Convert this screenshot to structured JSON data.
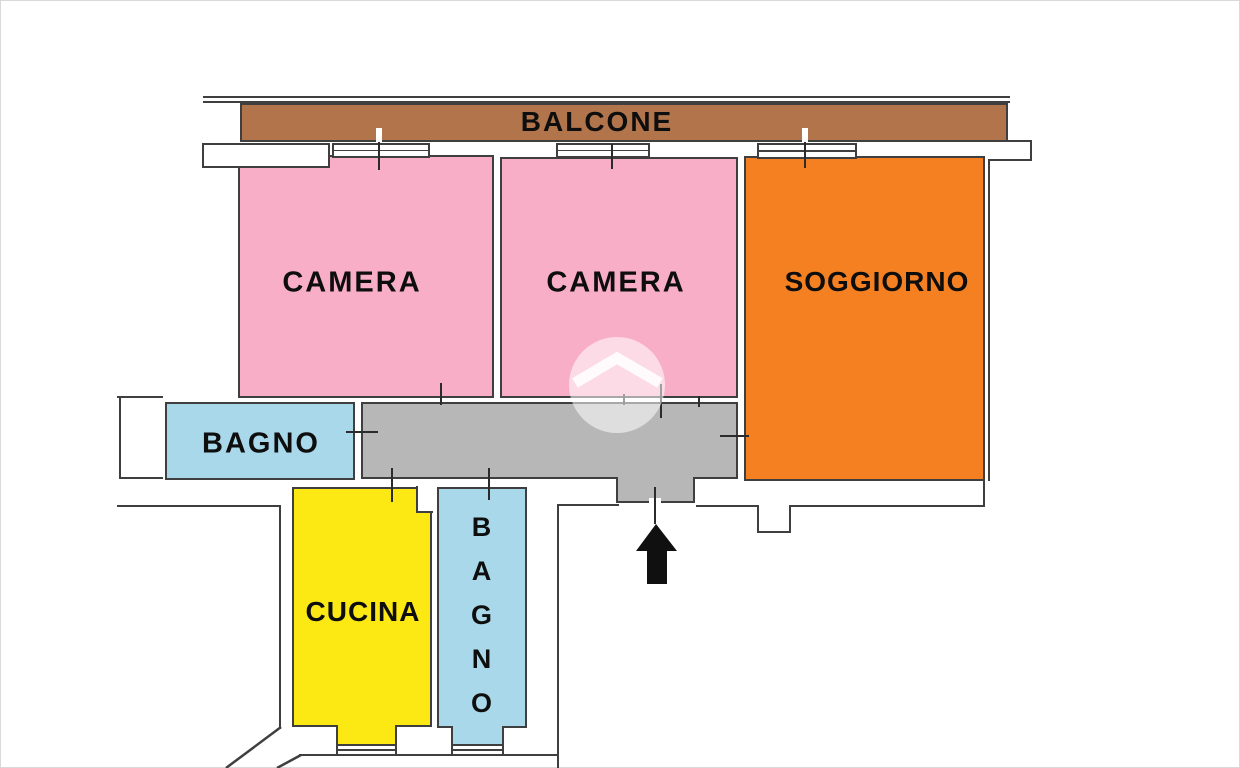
{
  "floor_plan": {
    "rooms": {
      "balcone": {
        "label": "BALCONE",
        "color": "#b1744b"
      },
      "camera_1": {
        "label": "CAMERA",
        "color": "#f9aec8"
      },
      "camera_2": {
        "label": "CAMERA",
        "color": "#f9aec8"
      },
      "soggiorno": {
        "label": "SOGGIORNO",
        "color": "#f58021"
      },
      "bagno_1": {
        "label": "BAGNO",
        "color": "#a8d8ea"
      },
      "cucina": {
        "label": "CUCINA",
        "color": "#fce813"
      },
      "bagno_2": {
        "label": "BAGNO",
        "color": "#a8d8ea"
      },
      "corridoio": {
        "label": "",
        "color": "#b7b7b7"
      }
    },
    "icons": {
      "entrance_arrow": "arrow-up-black",
      "watermark": "house-roof-in-circle"
    },
    "colors": {
      "background": "#ffffff",
      "wall_line": "#3f3f3f",
      "label_text": "#0e0e0e"
    }
  }
}
